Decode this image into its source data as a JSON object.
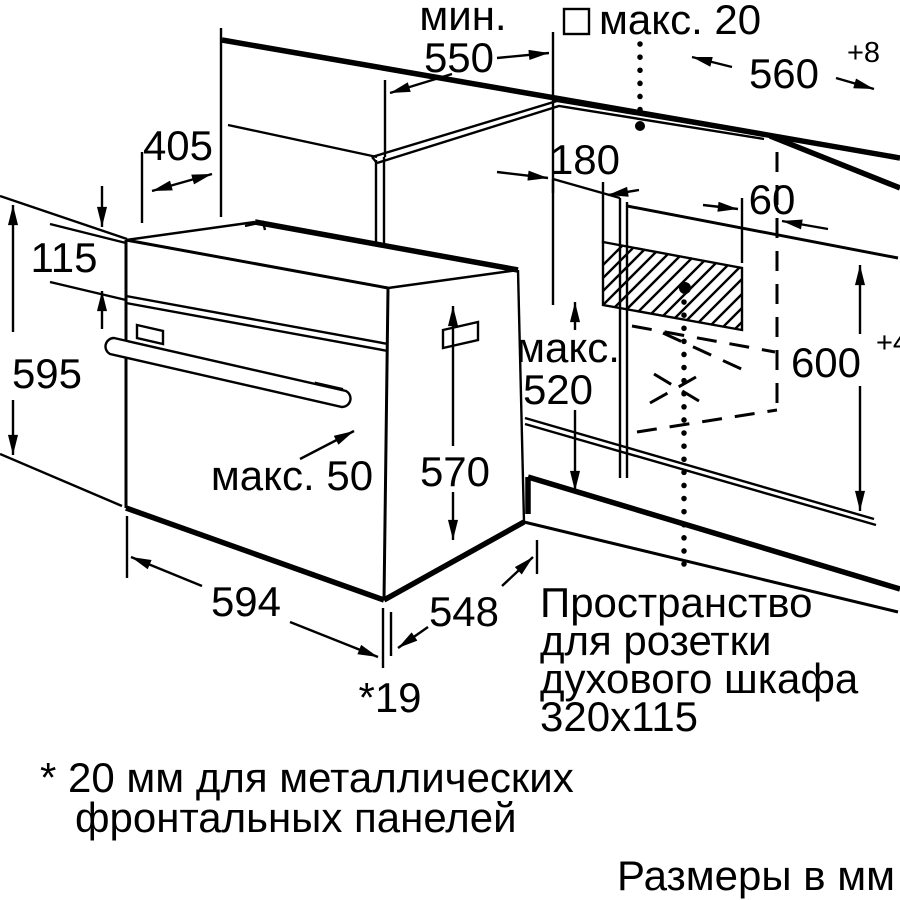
{
  "diagram": {
    "title_hint": "Built-in oven installation drawing",
    "dimensions": {
      "min_label": "мин.",
      "min_depth_value": "550",
      "max_panel_label": "макс. 20",
      "niche_width_value": "560",
      "niche_width_tolerance": "+8",
      "top_offset_value": "405",
      "socket_offset_value": "180",
      "socket_side_value": "60",
      "panel_height_value": "115",
      "oven_height_value": "595",
      "insert_max_label": "макс.",
      "insert_max_value": "520",
      "niche_height_value": "600",
      "niche_height_tolerance": "+4",
      "body_height_value": "570",
      "handle_max_label": "макс. 50",
      "oven_width_value": "594",
      "body_width_value": "548",
      "front_gap_value": "*19"
    },
    "notes": {
      "socket_line1": "Пространство",
      "socket_line2": "для розетки",
      "socket_line3": "духового шкафа",
      "socket_line4": "320x115",
      "footnote_line1": "* 20 мм для металлических",
      "footnote_line2": "фронтальных панелей",
      "units_note": "Размеры в мм"
    },
    "colors": {
      "ink": "#000000",
      "paper": "#ffffff"
    }
  }
}
